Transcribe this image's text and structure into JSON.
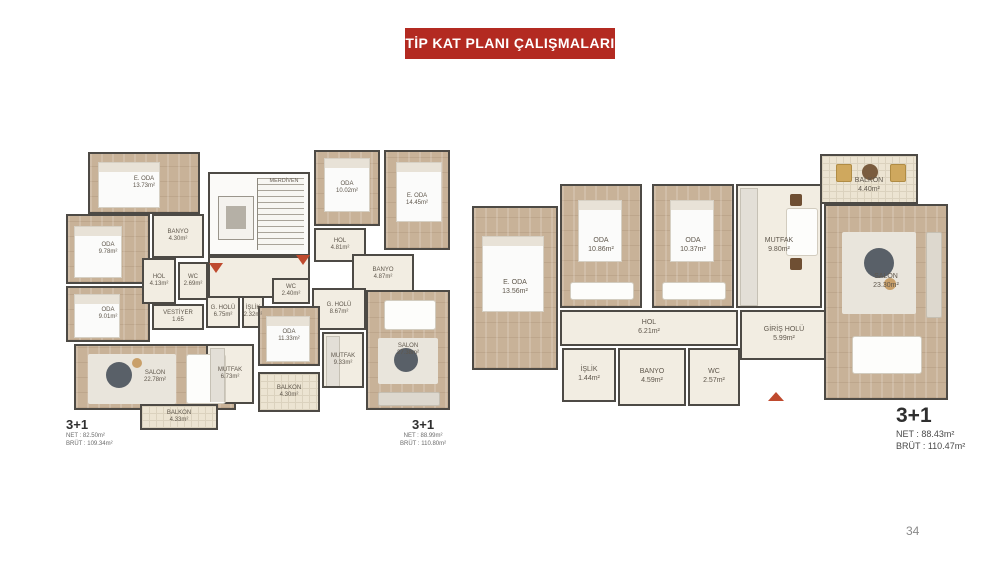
{
  "banner": {
    "title": "TİP KAT PLANI ÇALIŞMALARI",
    "bg_color": "#b32a21",
    "text_color": "#ffffff"
  },
  "page": {
    "number": "34"
  },
  "colors": {
    "wall": "#4d4a45",
    "wood_floor": "#c8b298",
    "light_floor": "#f2ede2",
    "entrance_arrow": "#bf4a2e"
  },
  "plans": [
    {
      "name": "left-floor-plan",
      "units": [
        {
          "type": "3+1",
          "net": "NET : 82.50m²",
          "brut": "BRÜT : 109.34m²"
        },
        {
          "type": "3+1",
          "net": "NET : 88.99m²",
          "brut": "BRÜT : 110.80m²"
        }
      ],
      "rooms": [
        {
          "name": "E. ODA",
          "area": "13.73m²"
        },
        {
          "name": "ODA",
          "area": "9.78m²"
        },
        {
          "name": "ODA",
          "area": "9.01m²"
        },
        {
          "name": "SALON",
          "area": "22.78m²"
        },
        {
          "name": "BALKON",
          "area": "4.33m²"
        },
        {
          "name": "MUTFAK",
          "area": "6.73m²"
        },
        {
          "name": "HOL",
          "area": "4.13m²"
        },
        {
          "name": "WC",
          "area": "2.69m²"
        },
        {
          "name": "BANYO",
          "area": "4.30m²"
        },
        {
          "name": "VESTİYER",
          "area": "1.65"
        },
        {
          "name": "G. HOLÜ",
          "area": "6.75m²"
        },
        {
          "name": "İŞLİK",
          "area": "2.32m²"
        },
        {
          "name": "MERDİVEN",
          "area": ""
        },
        {
          "name": "ODA",
          "area": "10.02m²"
        },
        {
          "name": "E. ODA",
          "area": "14.45m²"
        },
        {
          "name": "HOL",
          "area": "4.81m²"
        },
        {
          "name": "BANYO",
          "area": "4.87m²"
        },
        {
          "name": "WC",
          "area": "2.40m²"
        },
        {
          "name": "G. HOLÜ",
          "area": "8.67m²"
        },
        {
          "name": "ODA",
          "area": "11.33m²"
        },
        {
          "name": "MUTFAK",
          "area": "9.33m²"
        },
        {
          "name": "SALON",
          "area": "27.38m²"
        },
        {
          "name": "BALKON",
          "area": "4.30m²"
        }
      ]
    },
    {
      "name": "right-floor-plan",
      "unit": {
        "type": "3+1",
        "net": "NET :  88.43m²",
        "brut": "BRÜT : 110.47m²"
      },
      "rooms": [
        {
          "name": "E. ODA",
          "area": "13.56m²"
        },
        {
          "name": "ODA",
          "area": "10.86m²"
        },
        {
          "name": "ODA",
          "area": "10.37m²"
        },
        {
          "name": "MUTFAK",
          "area": "9.80m²"
        },
        {
          "name": "HOL",
          "area": "6.21m²"
        },
        {
          "name": "GİRİŞ HOLÜ",
          "area": "5.99m²"
        },
        {
          "name": "İŞLİK",
          "area": "1.44m²"
        },
        {
          "name": "BANYO",
          "area": "4.59m²"
        },
        {
          "name": "WC",
          "area": "2.57m²"
        },
        {
          "name": "SALON",
          "area": "23.30m²"
        },
        {
          "name": "BALKON",
          "area": "4.40m²"
        }
      ]
    }
  ]
}
